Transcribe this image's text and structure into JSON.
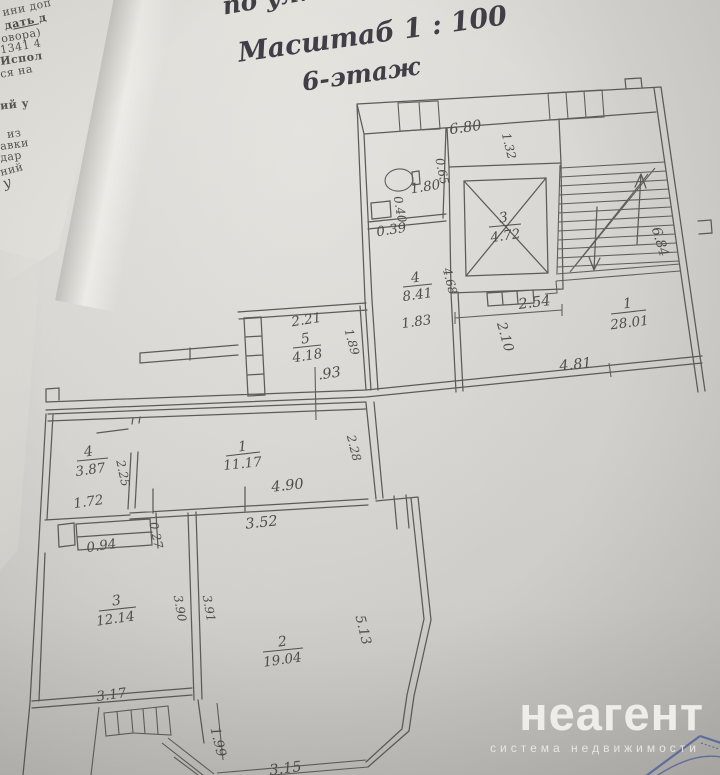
{
  "header": {
    "address_line": "по ул. Камо",
    "scale_line": "Масштаб  1 : 100",
    "floor_line": "6-этаж"
  },
  "underlying_document_fragments": {
    "f1": "ини доп",
    "f2": "дать д",
    "f3": "овора)",
    "f4": "1341 4",
    "f5": "Испол",
    "f6": "ся на",
    "f7": "ий у",
    "f8": "из",
    "f9": "авки",
    "f10": "дар",
    "f11": "ний",
    "f12": "у"
  },
  "plan": {
    "upper_unit": {
      "room1": {
        "num": "1",
        "area": "28.01"
      },
      "room3": {
        "num": "3",
        "area": "4.72"
      },
      "room4": {
        "num": "4",
        "area": "8.41"
      },
      "room5": {
        "num": "5",
        "area": "4.18"
      },
      "dims": {
        "d680": "6.80",
        "d132": "1.32",
        "d065": "0.65",
        "d180": "1.80",
        "d040": "0.40",
        "d039": "0.39",
        "d468": "4.68",
        "d254": "2.54",
        "d210": "2.10",
        "d183": "1.83",
        "d481": "4.81",
        "d684": "6.84",
        "d221": "2.21",
        "d189": "1.89",
        "d093": ".93"
      }
    },
    "lower_unit": {
      "room1": {
        "num": "1",
        "area": "11.17"
      },
      "room2": {
        "num": "2",
        "area": "19.04"
      },
      "room3": {
        "num": "3",
        "area": "12.14"
      },
      "room4": {
        "num": "4",
        "area": "3.87"
      },
      "dims": {
        "d225": "2.25",
        "d172": "1.72",
        "d228": "2.28",
        "d490": "4.90",
        "d352": "3.52",
        "d094": "0.94",
        "d027": "0.27",
        "d390": "3.90",
        "d391": "3.91",
        "d513": "5.13",
        "d317": "3.17",
        "d199": "1.99",
        "d315": "3.15"
      }
    }
  },
  "watermark": {
    "brand": "неагент",
    "tagline": "система недвижимости"
  }
}
